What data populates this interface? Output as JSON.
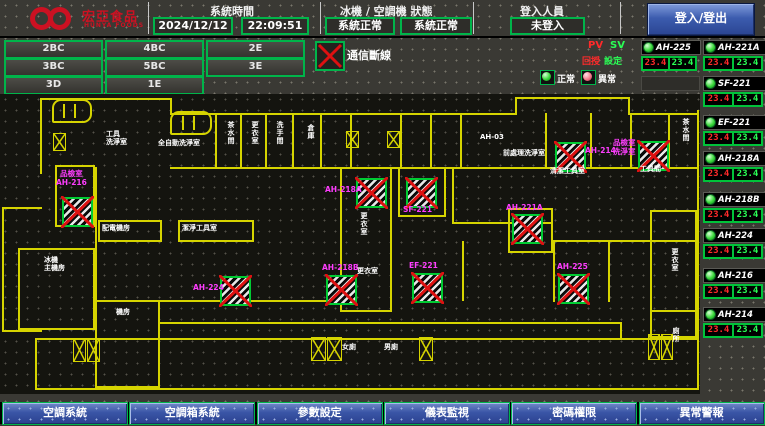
{
  "colors": {
    "wall_yellow": "#d6d400",
    "border_green": "#00b44a",
    "pv_red": "#ff2a2a",
    "sv_green": "#2aff55",
    "magenta": "#ff3dff",
    "alarm_red": "#dd1111",
    "panel_blue": "#3a55a6",
    "brand_red": "#cc1122"
  },
  "header": {
    "brand": {
      "zh": "宏亞食品",
      "en": "HUNYA FOODS"
    },
    "sections": [
      {
        "label": "系統時間",
        "values": [
          "2024/12/12",
          "22:09:51"
        ]
      },
      {
        "label": "冰機 / 空調機 狀態",
        "values": [
          "系統正常",
          "系統正常"
        ]
      },
      {
        "label": "登入人員",
        "values": [
          "未登入"
        ]
      }
    ],
    "login_button": "登入/登出"
  },
  "floor_buttons": [
    {
      "key": "2bc",
      "label": "2BC"
    },
    {
      "key": "4bc",
      "label": "4BC"
    },
    {
      "key": "2e",
      "label": "2E"
    },
    {
      "key": "3bc",
      "label": "3BC"
    },
    {
      "key": "5bc",
      "label": "5BC"
    },
    {
      "key": "3e",
      "label": "3E"
    },
    {
      "key": "3d",
      "label": "3D"
    },
    {
      "key": "1e",
      "label": "1E"
    }
  ],
  "comm_alarm": {
    "label": "通信斷線",
    "icon": "red-x-icon"
  },
  "legend": {
    "pv": "PV",
    "sv": "SV",
    "pv_zh": "回授",
    "sv_zh": "設定",
    "normal": "正常",
    "abnormal": "異常"
  },
  "devices": [
    {
      "key": "ah-225",
      "name": "AH-225",
      "pv": "23.4",
      "sv": "23.4",
      "col": 1,
      "y": 40,
      "status": "normal"
    },
    {
      "key": "ah-221a",
      "name": "AH-221A",
      "pv": "23.4",
      "sv": "23.4",
      "col": 2,
      "y": 40,
      "status": "normal"
    },
    {
      "key": "sf-221",
      "name": "SF-221",
      "pv": "23.4",
      "sv": "23.4",
      "col": 2,
      "y": 76,
      "status": "normal"
    },
    {
      "key": "ef-221",
      "name": "EF-221",
      "pv": "23.4",
      "sv": "23.4",
      "col": 2,
      "y": 115,
      "status": "normal"
    },
    {
      "key": "ah-218a",
      "name": "AH-218A",
      "pv": "23.4",
      "sv": "23.4",
      "col": 2,
      "y": 151,
      "status": "normal"
    },
    {
      "key": "ah-218b",
      "name": "AH-218B",
      "pv": "23.4",
      "sv": "23.4",
      "col": 2,
      "y": 192,
      "status": "normal"
    },
    {
      "key": "ah-224",
      "name": "AH-224",
      "pv": "23.4",
      "sv": "23.4",
      "col": 2,
      "y": 228,
      "status": "normal"
    },
    {
      "key": "ah-216",
      "name": "AH-216",
      "pv": "23.4",
      "sv": "23.4",
      "col": 2,
      "y": 268,
      "status": "normal"
    },
    {
      "key": "ah-214",
      "name": "AH-214",
      "pv": "23.4",
      "sv": "23.4",
      "col": 2,
      "y": 307,
      "status": "normal"
    }
  ],
  "map": {
    "walls_h": [
      [
        40,
        4,
        132
      ],
      [
        515,
        3,
        115
      ],
      [
        170,
        19,
        347
      ],
      [
        630,
        19,
        67
      ],
      [
        170,
        73,
        527
      ],
      [
        2,
        113,
        40
      ],
      [
        2,
        236,
        40
      ],
      [
        95,
        206,
        247
      ],
      [
        160,
        228,
        462
      ],
      [
        35,
        244,
        662
      ],
      [
        35,
        294,
        662
      ],
      [
        452,
        128,
        101
      ],
      [
        553,
        146,
        99
      ],
      [
        650,
        146,
        47
      ],
      [
        650,
        216,
        47
      ]
    ],
    "walls_v": [
      [
        40,
        4,
        76
      ],
      [
        170,
        4,
        17
      ],
      [
        2,
        113,
        125
      ],
      [
        95,
        73,
        135
      ],
      [
        215,
        19,
        56
      ],
      [
        240,
        19,
        56
      ],
      [
        265,
        19,
        56
      ],
      [
        292,
        19,
        56
      ],
      [
        320,
        19,
        56
      ],
      [
        350,
        19,
        56
      ],
      [
        400,
        19,
        56
      ],
      [
        430,
        19,
        56
      ],
      [
        460,
        19,
        56
      ],
      [
        545,
        19,
        56
      ],
      [
        590,
        19,
        56
      ],
      [
        630,
        19,
        56
      ],
      [
        668,
        19,
        56
      ],
      [
        515,
        3,
        18
      ],
      [
        628,
        3,
        18
      ],
      [
        452,
        73,
        57
      ],
      [
        697,
        16,
        280
      ],
      [
        35,
        246,
        50
      ],
      [
        620,
        228,
        18
      ],
      [
        553,
        146,
        62
      ],
      [
        608,
        146,
        62
      ],
      [
        462,
        147,
        60
      ]
    ],
    "rooms": [
      [
        55,
        71,
        40,
        62
      ],
      [
        18,
        154,
        77,
        82
      ],
      [
        98,
        126,
        64,
        22
      ],
      [
        178,
        126,
        76,
        22
      ],
      [
        340,
        73,
        52,
        145
      ],
      [
        398,
        73,
        48,
        50
      ],
      [
        508,
        114,
        45,
        45
      ],
      [
        95,
        206,
        65,
        88
      ],
      [
        650,
        116,
        47,
        128
      ]
    ],
    "stairs": [
      [
        53,
        39,
        13,
        18
      ],
      [
        346,
        37,
        13,
        17
      ],
      [
        387,
        37,
        13,
        17
      ],
      [
        73,
        244,
        13,
        24
      ],
      [
        87,
        244,
        13,
        24
      ],
      [
        311,
        243,
        15,
        24
      ],
      [
        327,
        243,
        15,
        24
      ],
      [
        419,
        243,
        14,
        24
      ],
      [
        648,
        240,
        12,
        26
      ],
      [
        661,
        240,
        12,
        26
      ]
    ],
    "lifts": [
      [
        52,
        5,
        40,
        24
      ],
      [
        170,
        17,
        42,
        24
      ]
    ],
    "equipment": [
      {
        "key": "ah-216",
        "label": "品檢室\nAH-216",
        "x": 62,
        "y": 103,
        "lx": 56,
        "ly": 76
      },
      {
        "key": "ah-224",
        "label": "AH-224",
        "x": 220,
        "y": 182,
        "lx": 193,
        "ly": 190
      },
      {
        "key": "ah-218b",
        "label": "AH-218B",
        "x": 326,
        "y": 181,
        "lx": 322,
        "ly": 170
      },
      {
        "key": "ef-221",
        "label": "EF-221",
        "x": 412,
        "y": 179,
        "lx": 409,
        "ly": 168
      },
      {
        "key": "ah-225",
        "label": "AH-225",
        "x": 558,
        "y": 180,
        "lx": 557,
        "ly": 169
      },
      {
        "key": "ah-218a",
        "label": "AH-218A",
        "x": 356,
        "y": 84,
        "lx": 325,
        "ly": 92
      },
      {
        "key": "sf-221",
        "label": "SF-221",
        "x": 406,
        "y": 84,
        "lx": 403,
        "ly": 112
      },
      {
        "key": "ah-221a",
        "label": "AH-221A",
        "x": 512,
        "y": 120,
        "lx": 506,
        "ly": 110
      },
      {
        "key": "ah-214",
        "label": "AH-214",
        "x": 555,
        "y": 48,
        "lx": 585,
        "ly": 53
      },
      {
        "key": "pinjian",
        "label": "品檢室\n洗淨室",
        "x": 638,
        "y": 47,
        "lx": 613,
        "ly": 45
      }
    ],
    "labels": [
      {
        "text": "工具\n洗淨室",
        "x": 106,
        "y": 36
      },
      {
        "text": "全自動洗淨室",
        "x": 158,
        "y": 45
      },
      {
        "text": "茶水間",
        "x": 227,
        "y": 27,
        "vert": true
      },
      {
        "text": "更衣室",
        "x": 251,
        "y": 27,
        "vert": true
      },
      {
        "text": "洗手間",
        "x": 276,
        "y": 27,
        "vert": true
      },
      {
        "text": "倉庫",
        "x": 307,
        "y": 30,
        "vert": true
      },
      {
        "text": "AH-03",
        "x": 480,
        "y": 39
      },
      {
        "text": "前處理洗淨室",
        "x": 503,
        "y": 55
      },
      {
        "text": "清潔工具室",
        "x": 550,
        "y": 73
      },
      {
        "text": "工具間",
        "x": 640,
        "y": 71
      },
      {
        "text": "茶水間",
        "x": 682,
        "y": 24,
        "vert": true
      },
      {
        "text": "更衣室",
        "x": 360,
        "y": 118,
        "vert": true
      },
      {
        "text": "更衣室",
        "x": 357,
        "y": 173
      },
      {
        "text": "配電機房",
        "x": 102,
        "y": 130
      },
      {
        "text": "潔淨工具室",
        "x": 182,
        "y": 130
      },
      {
        "text": "冰機\n主機房",
        "x": 44,
        "y": 162
      },
      {
        "text": "機房",
        "x": 116,
        "y": 214
      },
      {
        "text": "女廁",
        "x": 342,
        "y": 249
      },
      {
        "text": "男廁",
        "x": 384,
        "y": 249
      },
      {
        "text": "更衣室",
        "x": 671,
        "y": 154,
        "vert": true
      },
      {
        "text": "廁所",
        "x": 672,
        "y": 233,
        "vert": true
      }
    ]
  },
  "bottom_nav": [
    {
      "key": "ac-system",
      "label": "空調系統"
    },
    {
      "key": "ahu-system",
      "label": "空調箱系統"
    },
    {
      "key": "param-setting",
      "label": "參數設定"
    },
    {
      "key": "meter-monitor",
      "label": "儀表監視"
    },
    {
      "key": "password-auth",
      "label": "密碼權限"
    },
    {
      "key": "alarm",
      "label": "異常警報"
    }
  ]
}
